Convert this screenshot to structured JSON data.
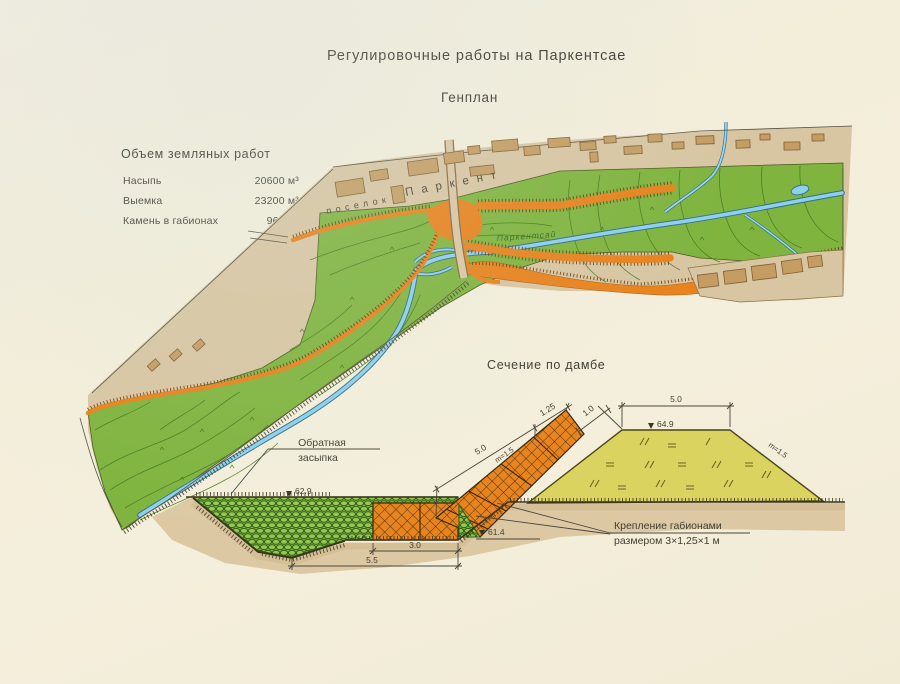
{
  "title": "Регулировочные работы на Паркентсае",
  "subtitle": "Генплан",
  "earthworks": {
    "heading": "Объем земляных работ",
    "rows": [
      {
        "label": "Насыпь",
        "value": "20600 м³"
      },
      {
        "label": "Выемка",
        "value": "23200 м³"
      },
      {
        "label": "Камень в габионах",
        "value": "960 м³"
      }
    ]
  },
  "map": {
    "settlement_word1": "поселок",
    "settlement_word2": "Паркент",
    "river_label": "Паркентсай"
  },
  "section": {
    "heading": "Сечение по дамбе",
    "backfill_line1": "Обратная",
    "backfill_line2": "засыпка",
    "note_line1": "Крепление габионами",
    "note_line2": "размером 3×1,25×1 м",
    "elev_backfill": "62.9",
    "elev_ground": "61.4",
    "elev_crest": "64.9",
    "dim_crest": "5.0",
    "dim_slope": "5.0",
    "dim_slope_upper": "1.25",
    "dim_gabion_thickness": "1.0",
    "dim_mattress": "3.0",
    "dim_excavation": "5.5",
    "slope_gabion": "m=1.5",
    "slope_right": "m=1.5"
  },
  "colors": {
    "paper": "#f3eeda",
    "terrace_tan": "#d8c6a2",
    "floodplain_green": "#7fb43e",
    "dike_orange": "#e8821c",
    "river_blue": "#8ed0ea",
    "dam_yellow": "#dbd35f",
    "building_brown": "#c59d63",
    "contour_green": "#41761b"
  }
}
